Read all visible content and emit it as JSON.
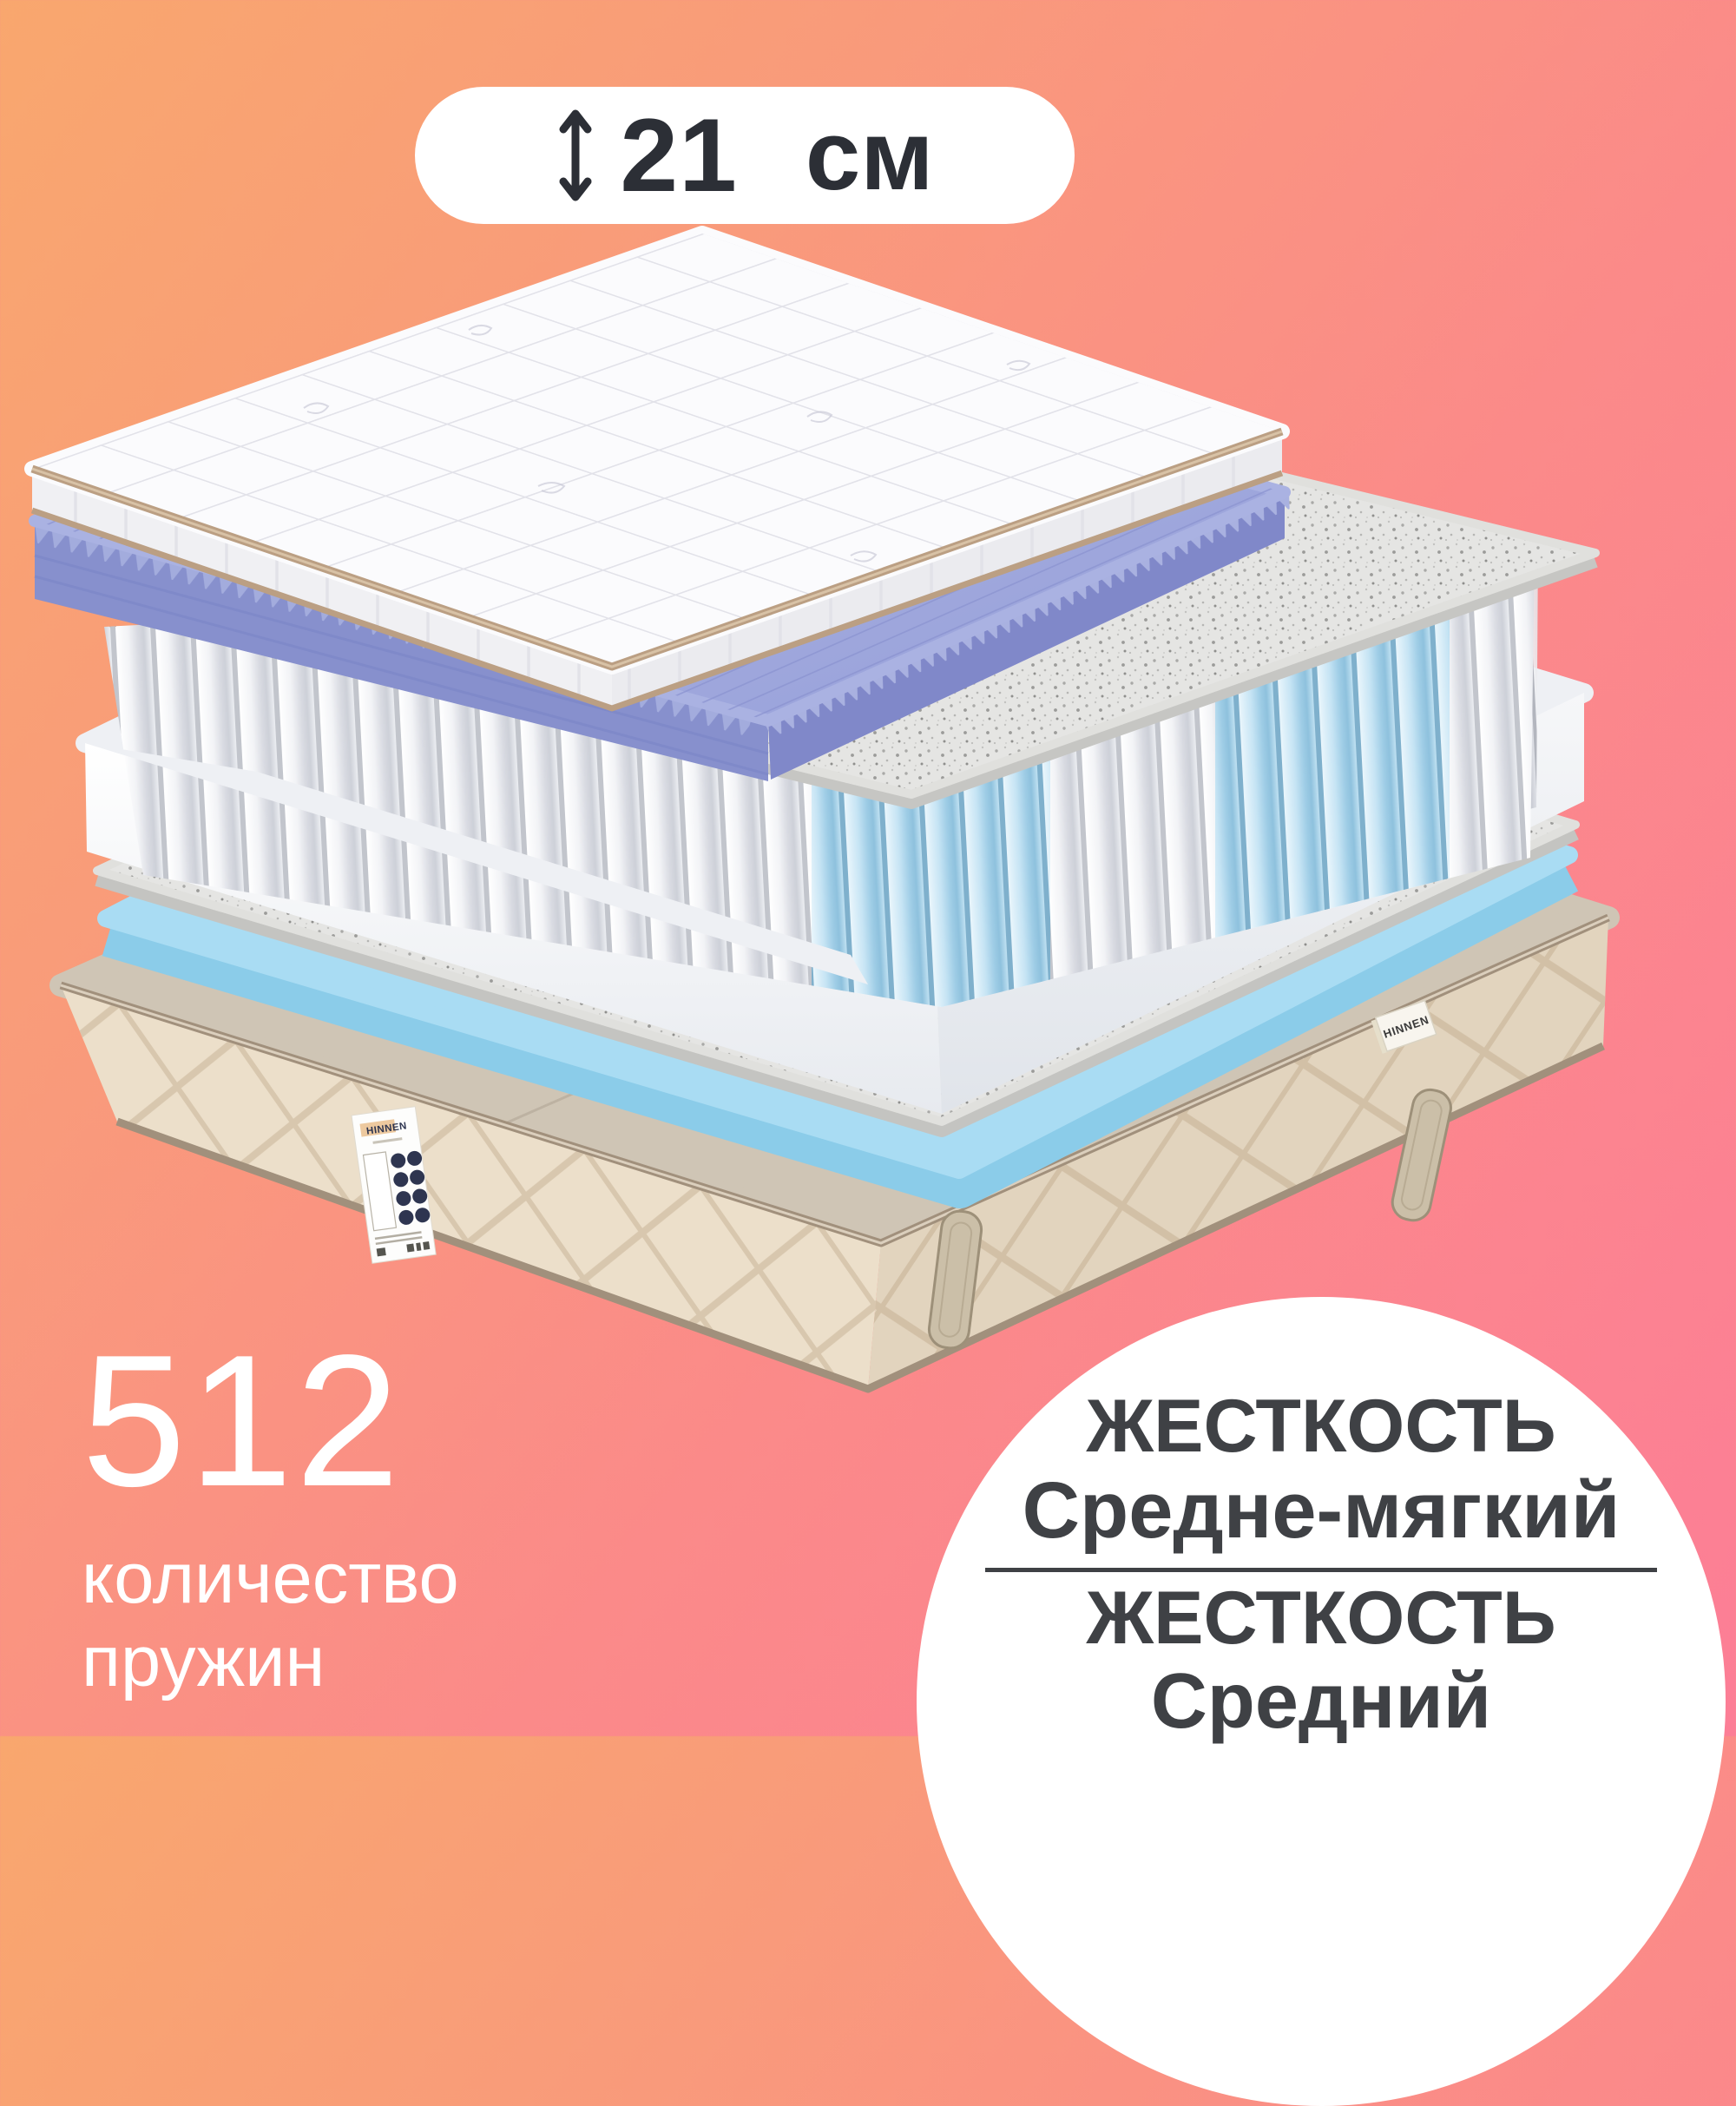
{
  "badge": {
    "icon": "height-double-arrow-icon",
    "value": "21",
    "unit": "см"
  },
  "springs_stat": {
    "count": "512",
    "caption_line1": "количество",
    "caption_line2": "пружин"
  },
  "firmness_badge": {
    "side_a_label": "ЖЕСТКОСТЬ",
    "side_a_value": "Средне-мягкий",
    "side_b_label": "ЖЕСТКОСТЬ",
    "side_b_value": "Средний"
  },
  "brand": {
    "front_label": "HINNEN",
    "side_tag": "HINNEN"
  },
  "colors": {
    "background_gradient_start": "#f9a76e",
    "background_gradient_end": "#fc7e96",
    "badge_background": "#ffffff",
    "badge_text": "#2c2f36",
    "stat_text": "#ffffff",
    "circle_background": "#ffffff",
    "firmness_text": "#3f4145",
    "quilt_top": "#fbfbfd",
    "quilt_piping": "#bb9f83",
    "wave_foam_top": "#a9b1e0",
    "wave_foam_side": "#8790cd",
    "felt": "#e5e5e3",
    "spring_pocket": "#f2f3f6",
    "spring_blue_zone": "#aed7ec",
    "foam_box_top": "#eef0f4",
    "cooling_foam_top": "#a9dcf3",
    "cooling_foam_side": "#8bcce9",
    "base_top_band": "#cfc5b5",
    "base_fabric": "#ecdfca",
    "base_piping": "#a1907c",
    "label_background": "#fdfdfc",
    "label_accent": "#edc99f",
    "label_brand_text": "#2e3550"
  }
}
